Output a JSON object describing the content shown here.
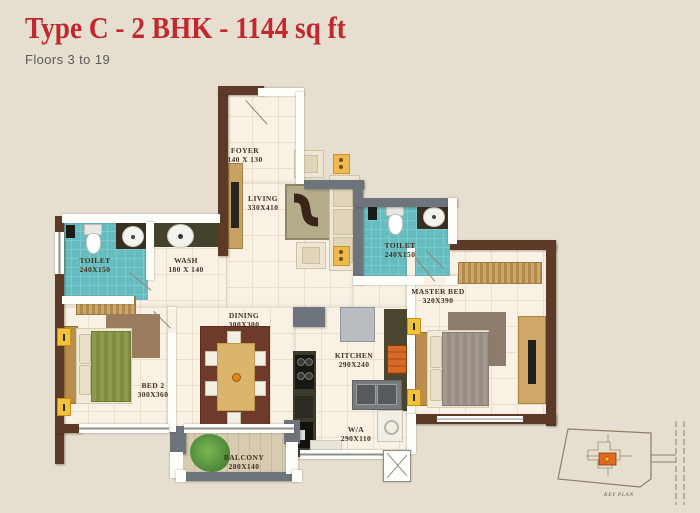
{
  "header": {
    "title": "Type C - 2 BHK - 1144 sq ft",
    "subtitle": "Floors 3 to 19"
  },
  "plan": {
    "rooms": {
      "foyer": {
        "name": "FOYER",
        "dim": "140 X 130"
      },
      "living": {
        "name": "LIVING",
        "dim": "330X410"
      },
      "toilet_left": {
        "name": "TOILET",
        "dim": "240X150"
      },
      "wash": {
        "name": "WASH",
        "dim": "180 X 140"
      },
      "toilet_right": {
        "name": "TOILET",
        "dim": "240X150"
      },
      "master_bed": {
        "name": "MASTER BED",
        "dim": "320X390"
      },
      "bed_2": {
        "name": "BED 2",
        "dim": "300X360"
      },
      "dining": {
        "name": "DINING",
        "dim": "300X300"
      },
      "kitchen": {
        "name": "KITCHEN",
        "dim": "290X240"
      },
      "wa": {
        "name": "W/A",
        "dim": "290X110"
      },
      "balcony": {
        "name": "BALCONY",
        "dim": "280X140"
      }
    },
    "key_plan_label": "KEY PLAN"
  },
  "colors": {
    "background": "#e6dfd0",
    "title_red": "#c1272d",
    "subtitle_gray": "#5b5b5b",
    "wall_brown": "#5d3a28",
    "wall_gray": "#6d747b",
    "floor_cream": "#f8f1e4",
    "tile_teal": "#67bcc0",
    "marker_yellow": "#f2c23e",
    "accent_orange": "#d86a28"
  }
}
